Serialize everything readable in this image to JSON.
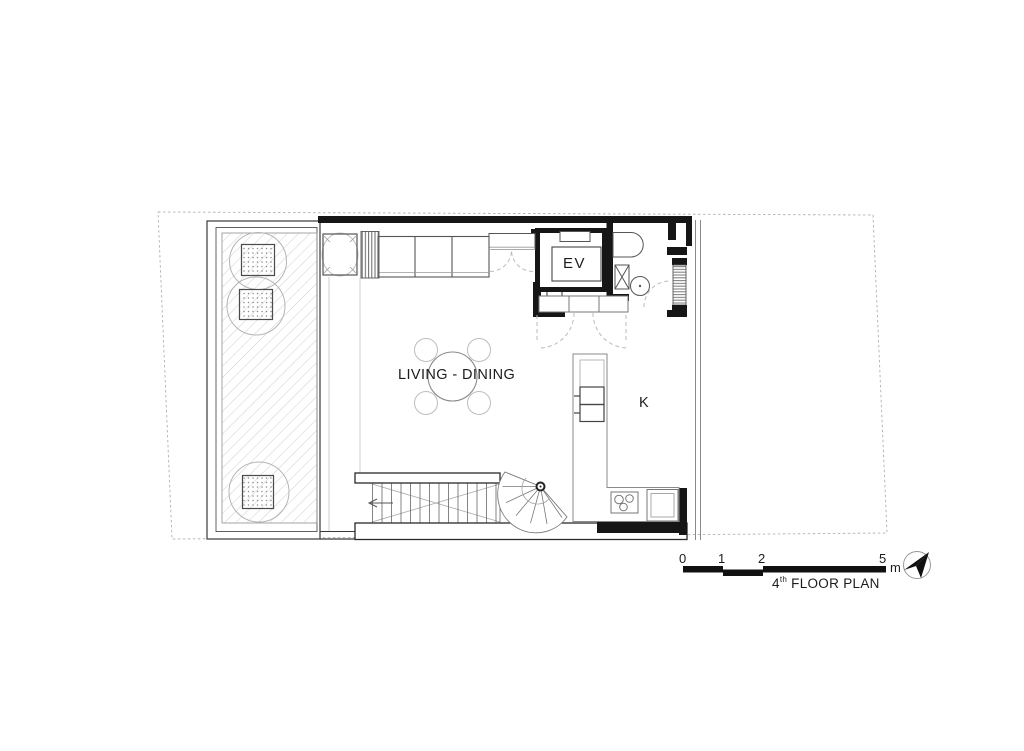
{
  "drawing": {
    "labels": {
      "living_dining": "LIVING - DINING",
      "elevator": "EV",
      "kitchen": "K"
    },
    "title": {
      "floor_number": "4",
      "ordinal_suffix": "th",
      "name": " FLOOR PLAN"
    },
    "scale_bar": {
      "tick_0": "0",
      "tick_1": "1",
      "tick_2": "2",
      "tick_3": "5",
      "unit": "m"
    },
    "icons": {
      "north_arrow": "north-arrow"
    },
    "colors": {
      "ink": "#161616",
      "light_line": "#bbbbbb",
      "hatch_line": "#cfcfcf",
      "background": "#ffffff"
    }
  }
}
